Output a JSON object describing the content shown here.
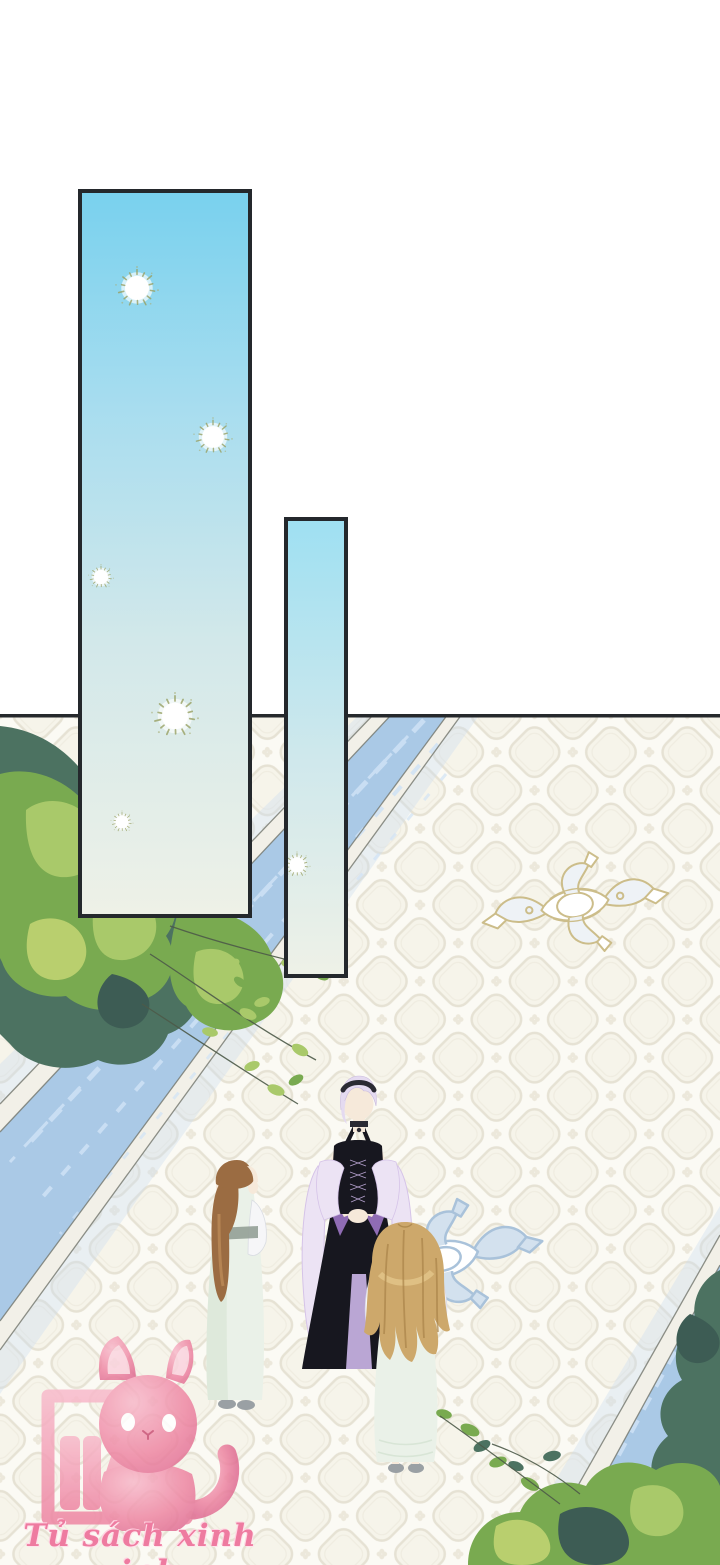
{
  "page": {
    "kind": "webtoon comic page"
  },
  "watermark": {
    "text": "Tủ sách xinh xinh"
  },
  "icons": {
    "sparkle": "dandelion-puff-sparkle",
    "mascot": "pink-cat-with-bookshelf"
  },
  "colors": {
    "panel-border": "#24282c",
    "panel-sky-1": "#79d1ee",
    "panel2-sky": "#9fe0f2",
    "panel-fade": "#eef1e7",
    "scene-line": "#26292c",
    "tile-base": "#fbfaf4",
    "tile-line": "#e6e2d4",
    "water-blue": "#aac9e6",
    "water-light": "#cfe2f6",
    "stone": "#f2f0e8",
    "stone-line": "#73766d",
    "grass-light": "#a9c96a",
    "grass-mid": "#79aa50",
    "grass-yellow": "#b9cf6e",
    "grass-dark": "#4c7261",
    "grass-deep": "#3d5c54",
    "branch": "#4d5a49",
    "gold": "#ccbd8a",
    "ornament-blue": "#a9c2da",
    "ornament-blue-light": "#d3e1ee",
    "skin": "#f6e9da",
    "hair-lavender": "#e4daf0",
    "hair-lavender-shade": "#c9bade",
    "headband": "#2a2a33",
    "dress-black": "#17171f",
    "purple": "#8f6cb4",
    "purple-light": "#c3aede",
    "shawl": "#ece3f4",
    "shawl-edge": "#d5c3e8",
    "hair-brown": "#9b6c42",
    "hair-brown-light": "#bb8b58",
    "hair-blonde": "#cda86b",
    "hair-blonde-light": "#e2c488",
    "hair-blonde-shade": "#aa8449",
    "dress-mint": "#eaf1e8",
    "dress-mint-shade": "#d8e5d6",
    "sleeve-white": "#f6f6f8",
    "sash": "#93a096",
    "shoe-gray": "#9aa0a4",
    "mascot-pink": "#ee86a3",
    "mascot-pink-light": "#f8bacb",
    "mascot-pink-dark": "#e06d93",
    "watermark-pink": "#ee7ba0"
  }
}
